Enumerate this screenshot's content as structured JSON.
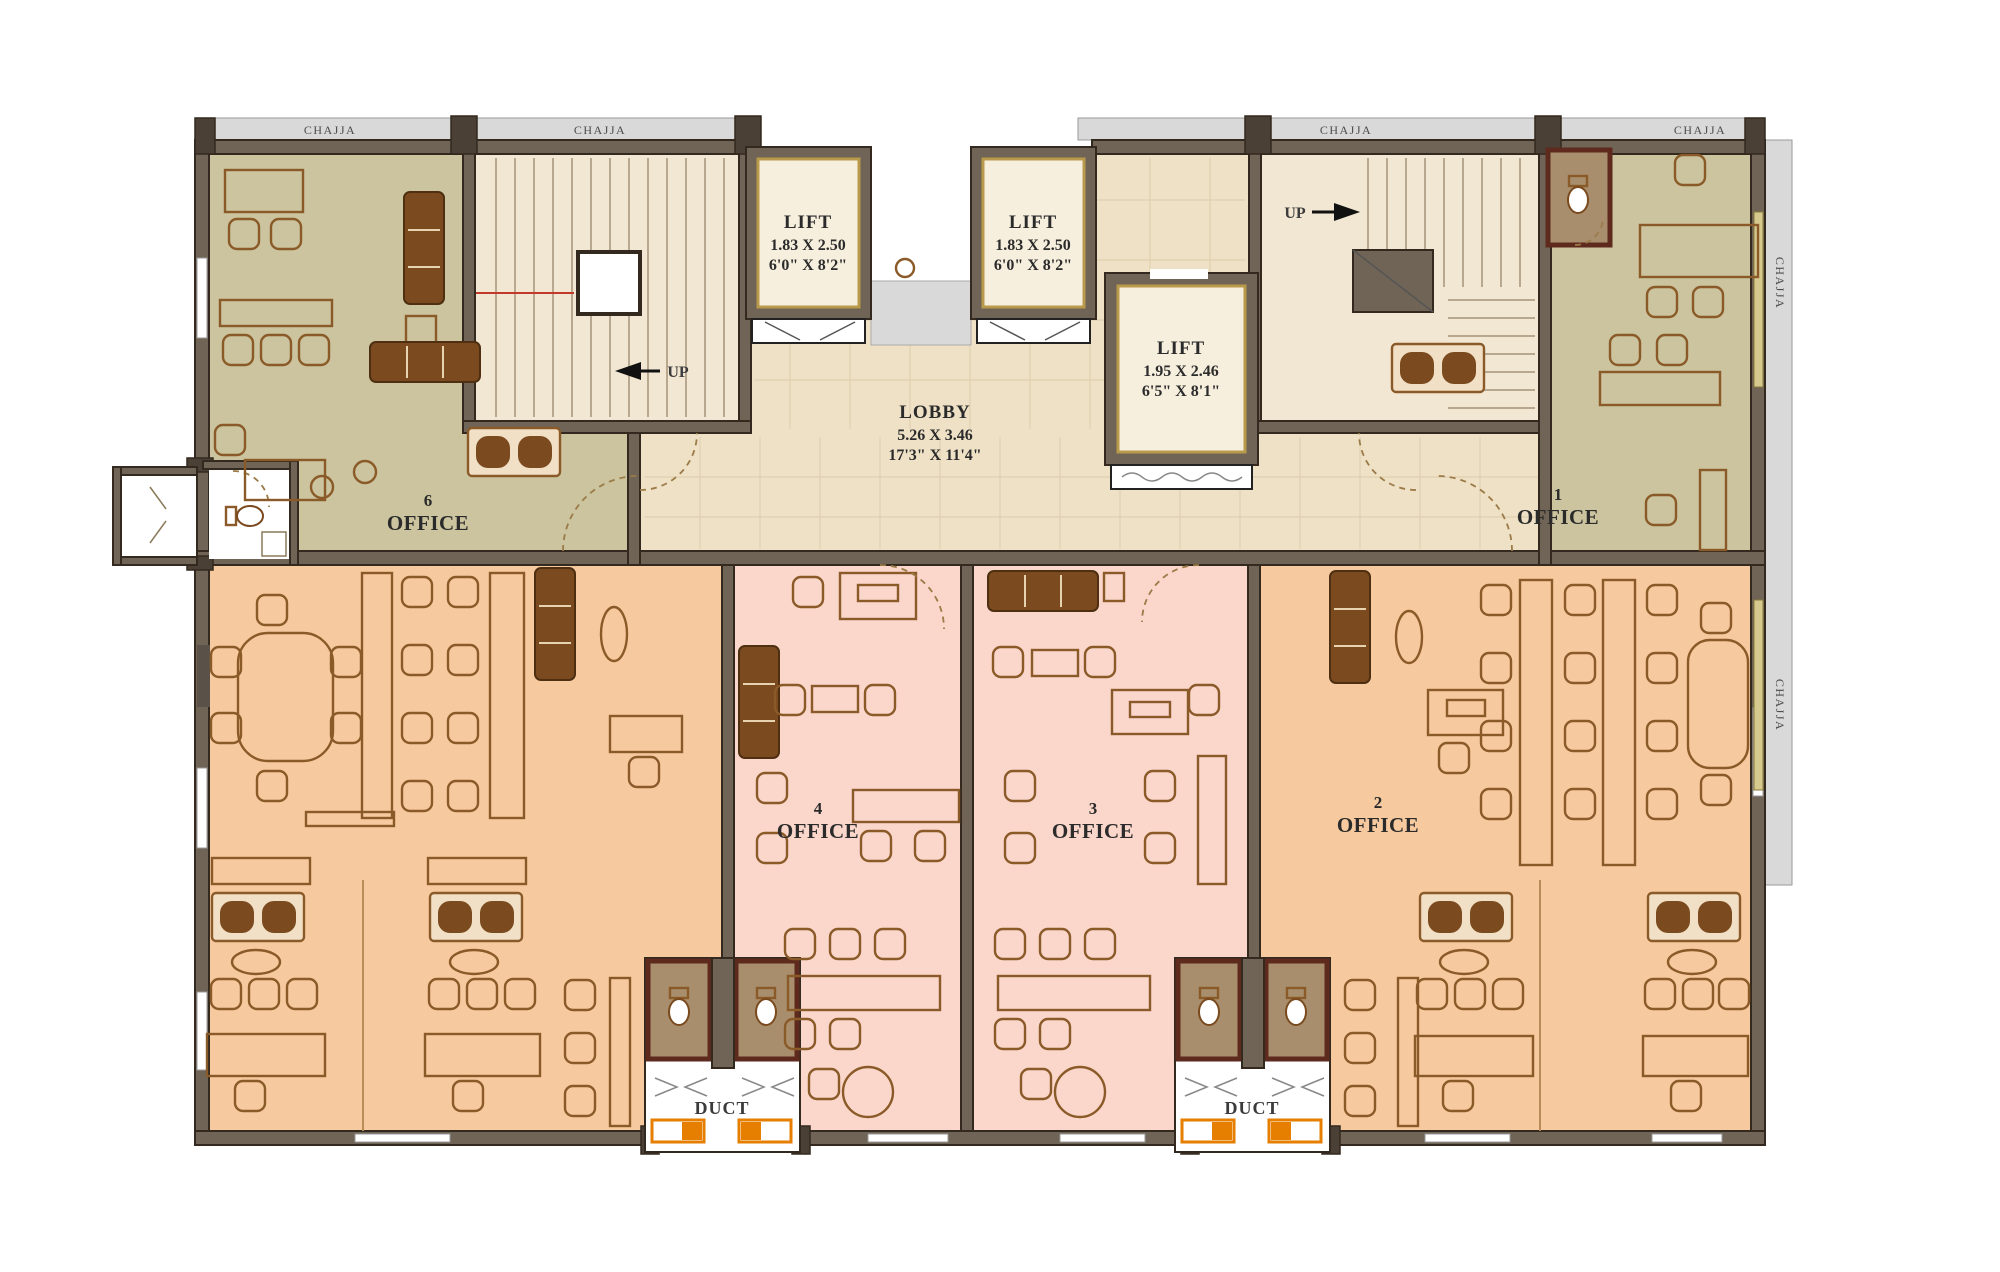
{
  "colors": {
    "wall": "#6f6455",
    "wall-dark": "#33291f",
    "olive": "#cbc49e",
    "cream": "#f2e7d2",
    "tan": "#efe1c6",
    "orange": "#f7c99e",
    "pink": "#fbd6ca",
    "gray": "#d9d9d9",
    "grid": "#dfd0b1",
    "furn": "#8a5a28",
    "sofa": "#7b4b1f",
    "gold": "#b99a4a",
    "accent": "#e67e00",
    "wc": "#a88e6d",
    "wc-wall": "#5f2a1e",
    "window": "#d6c98e",
    "red": "#c0392b"
  },
  "chajja": {
    "label": "CHAJJA"
  },
  "lobby": {
    "name": "LOBBY",
    "size_m": "5.26 X 3.46",
    "size_ft": "17'3\" X 11'4\""
  },
  "lifts": [
    {
      "name": "LIFT",
      "size_m": "1.83 X 2.50",
      "size_ft": "6'0\" X 8'2\""
    },
    {
      "name": "LIFT",
      "size_m": "1.83 X 2.50",
      "size_ft": "6'0\" X 8'2\""
    },
    {
      "name": "LIFT",
      "size_m": "1.95 X 2.46",
      "size_ft": "6'5\" X 8'1\""
    }
  ],
  "offices": [
    {
      "number": "6",
      "label": "OFFICE"
    },
    {
      "number": "1",
      "label": "OFFICE"
    },
    {
      "number": "4",
      "label": "OFFICE"
    },
    {
      "number": "3",
      "label": "OFFICE"
    },
    {
      "number": "2",
      "label": "OFFICE"
    }
  ],
  "stairs": {
    "up": "UP"
  },
  "ducts": {
    "label": "DUCT"
  }
}
